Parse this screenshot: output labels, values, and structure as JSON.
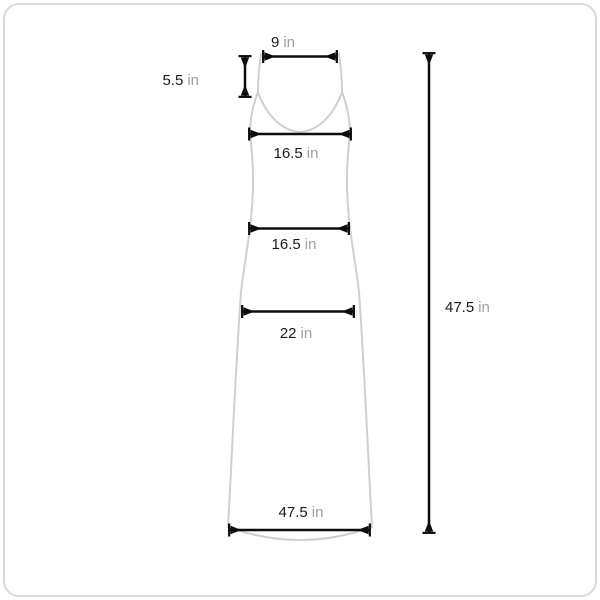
{
  "page": {
    "background_color": "#ffffff",
    "frame_border_color": "#d9d9d9"
  },
  "diagram": {
    "kind": "garment-measurement-diagram",
    "garment": "sleeveless-maxi-dress",
    "colors": {
      "garment_outline": "#cfcfcf",
      "dimension_arrow": "#0d0d0d",
      "value_text": "#1a1a1a",
      "unit_text": "#9e9e9e"
    },
    "measurements": [
      {
        "id": "strap-width",
        "value": "9",
        "unit": "in"
      },
      {
        "id": "strap-length",
        "value": "5.5",
        "unit": "in"
      },
      {
        "id": "bust-width",
        "value": "16.5",
        "unit": "in"
      },
      {
        "id": "waist-width",
        "value": "16.5",
        "unit": "in"
      },
      {
        "id": "hip-width",
        "value": "22",
        "unit": "in"
      },
      {
        "id": "hem-width",
        "value": "47.5",
        "unit": "in"
      },
      {
        "id": "total-length",
        "value": "47.5",
        "unit": "in"
      }
    ]
  }
}
